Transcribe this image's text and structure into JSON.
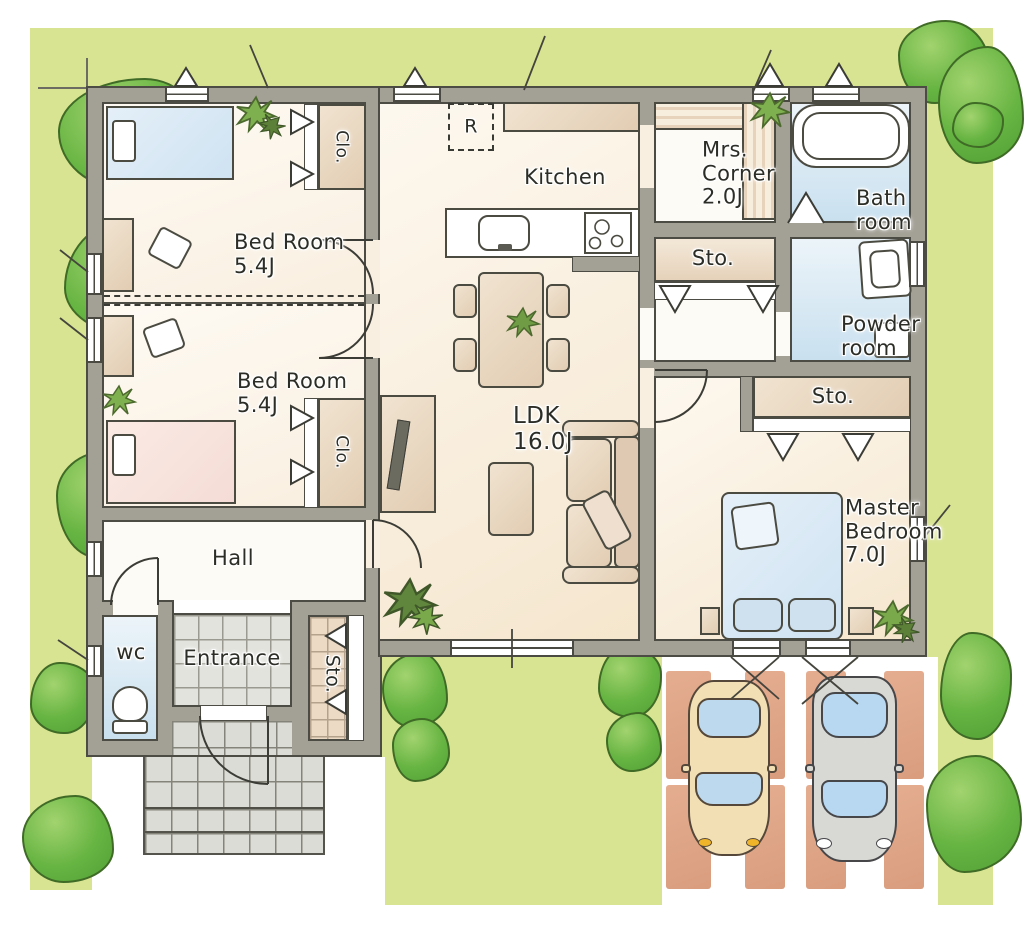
{
  "title": "One-story house floor plan",
  "rooms": {
    "bedroom1": {
      "name": "Bed Room",
      "size": "5.4J"
    },
    "bedroom2": {
      "name": "Bed Room",
      "size": "5.4J"
    },
    "closet1": {
      "name": "Clo."
    },
    "closet2": {
      "name": "Clo."
    },
    "hall": {
      "name": "Hall"
    },
    "wc": {
      "name": "wc"
    },
    "entrance": {
      "name": "Entrance"
    },
    "entrance_storage": {
      "name": "Sto."
    },
    "kitchen": {
      "name": "Kitchen"
    },
    "refrigerator": {
      "label": "R"
    },
    "ldk": {
      "name": "LDK",
      "size": "16.0J"
    },
    "mrs_corner": {
      "name_line1": "Mrs.",
      "name_line2": "Corner",
      "size": "2.0J"
    },
    "kitchen_storage": {
      "name": "Sto."
    },
    "bathroom": {
      "name_line1": "Bath",
      "name_line2": "room"
    },
    "powder_room": {
      "name_line1": "Powder",
      "name_line2": "room"
    },
    "master_storage": {
      "name": "Sto."
    },
    "master_bedroom": {
      "name_line1": "Master",
      "name_line2": "Bedroom",
      "size": "7.0J"
    }
  },
  "colors": {
    "grass": "#d9e492",
    "wall": "#a3a196",
    "ink": "#4c4c44",
    "floor_cream": "#f8ecd9",
    "water_blue": "#cfe3f2",
    "storage_tan": "#e6d2ba",
    "parking_brick": "#dfa386",
    "car_tan": "#f2dfb4",
    "car_gray": "#d8d8d4",
    "tree_green": "#66b442"
  }
}
